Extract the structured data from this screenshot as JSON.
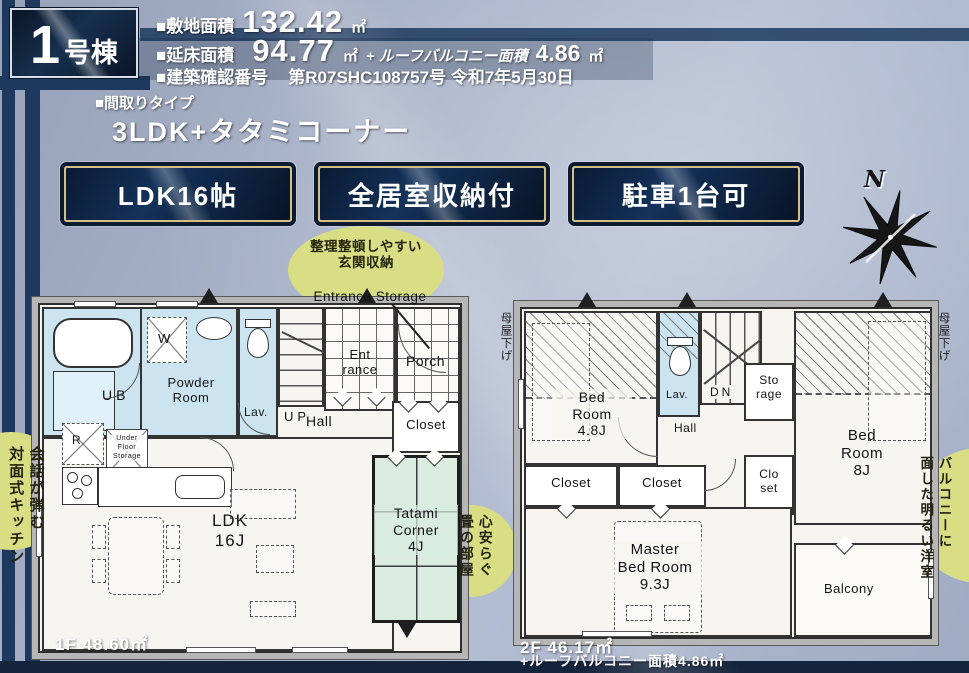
{
  "header": {
    "badge_number": "1",
    "badge_suffix": "号棟",
    "site_area_label": "■敷地面積",
    "site_area_value": "132.42",
    "site_area_unit": "㎡",
    "floor_area_label": "■延床面積",
    "floor_area_value": "94.77",
    "floor_area_unit": "㎡",
    "roof_balcony_label": "+ ルーフバルコニー面積",
    "roof_balcony_value": "4.86",
    "roof_balcony_unit": "㎡",
    "permit_label": "■建築確認番号",
    "permit_value": "第R07SHC108757号 令和7年5月30日"
  },
  "layout_type": {
    "label": "■間取りタイプ",
    "value": "3LDK+タタミコーナー"
  },
  "feature_badges": [
    "LDK16帖",
    "全居室収納付",
    "駐車1台可"
  ],
  "compass": {
    "north": "N"
  },
  "annotations": {
    "entrance_storage_jp": "整理整頓しやすい\n玄関収納",
    "entrance_storage_en": "Entrance Storage",
    "kitchen": "会話が弾む\n対面式キッチン",
    "tatami": "心安らぐ\n畳の部屋",
    "balcony_room": "バルコニーに\n面した明るい洋室",
    "moya_sage_left": "母屋下げ",
    "moya_sage_right": "母屋下げ"
  },
  "floor1": {
    "area": "1F 48.60㎡",
    "rooms": {
      "ub": "UB",
      "washer": "W",
      "powder": "Powder\nRoom",
      "lav": "Lav.",
      "up": "UP",
      "entrance": "Ent\nrance",
      "porch": "Porch",
      "hall": "Hall",
      "closet": "Closet",
      "refrigerator": "R",
      "under_floor_storage": "Under\nFloor\nStorage",
      "ldk": "LDK\n16J",
      "tatami": "Tatami\nCorner\n4J"
    }
  },
  "floor2": {
    "area": "2F 46.17㎡",
    "area_note": "+ルーフバルコニー面積4.86㎡",
    "rooms": {
      "bed48": "Bed\nRoom\n4.8J",
      "lav": "Lav.",
      "dn": "DN",
      "storage": "Sto\nrage",
      "hall": "Hall",
      "bed8": "Bed\nRoom\n8J",
      "closet1": "Closet",
      "closet2": "Closet",
      "closet3": "Clo\nset",
      "master": "Master\nBed Room\n9.3J",
      "balcony": "Balcony"
    }
  }
}
